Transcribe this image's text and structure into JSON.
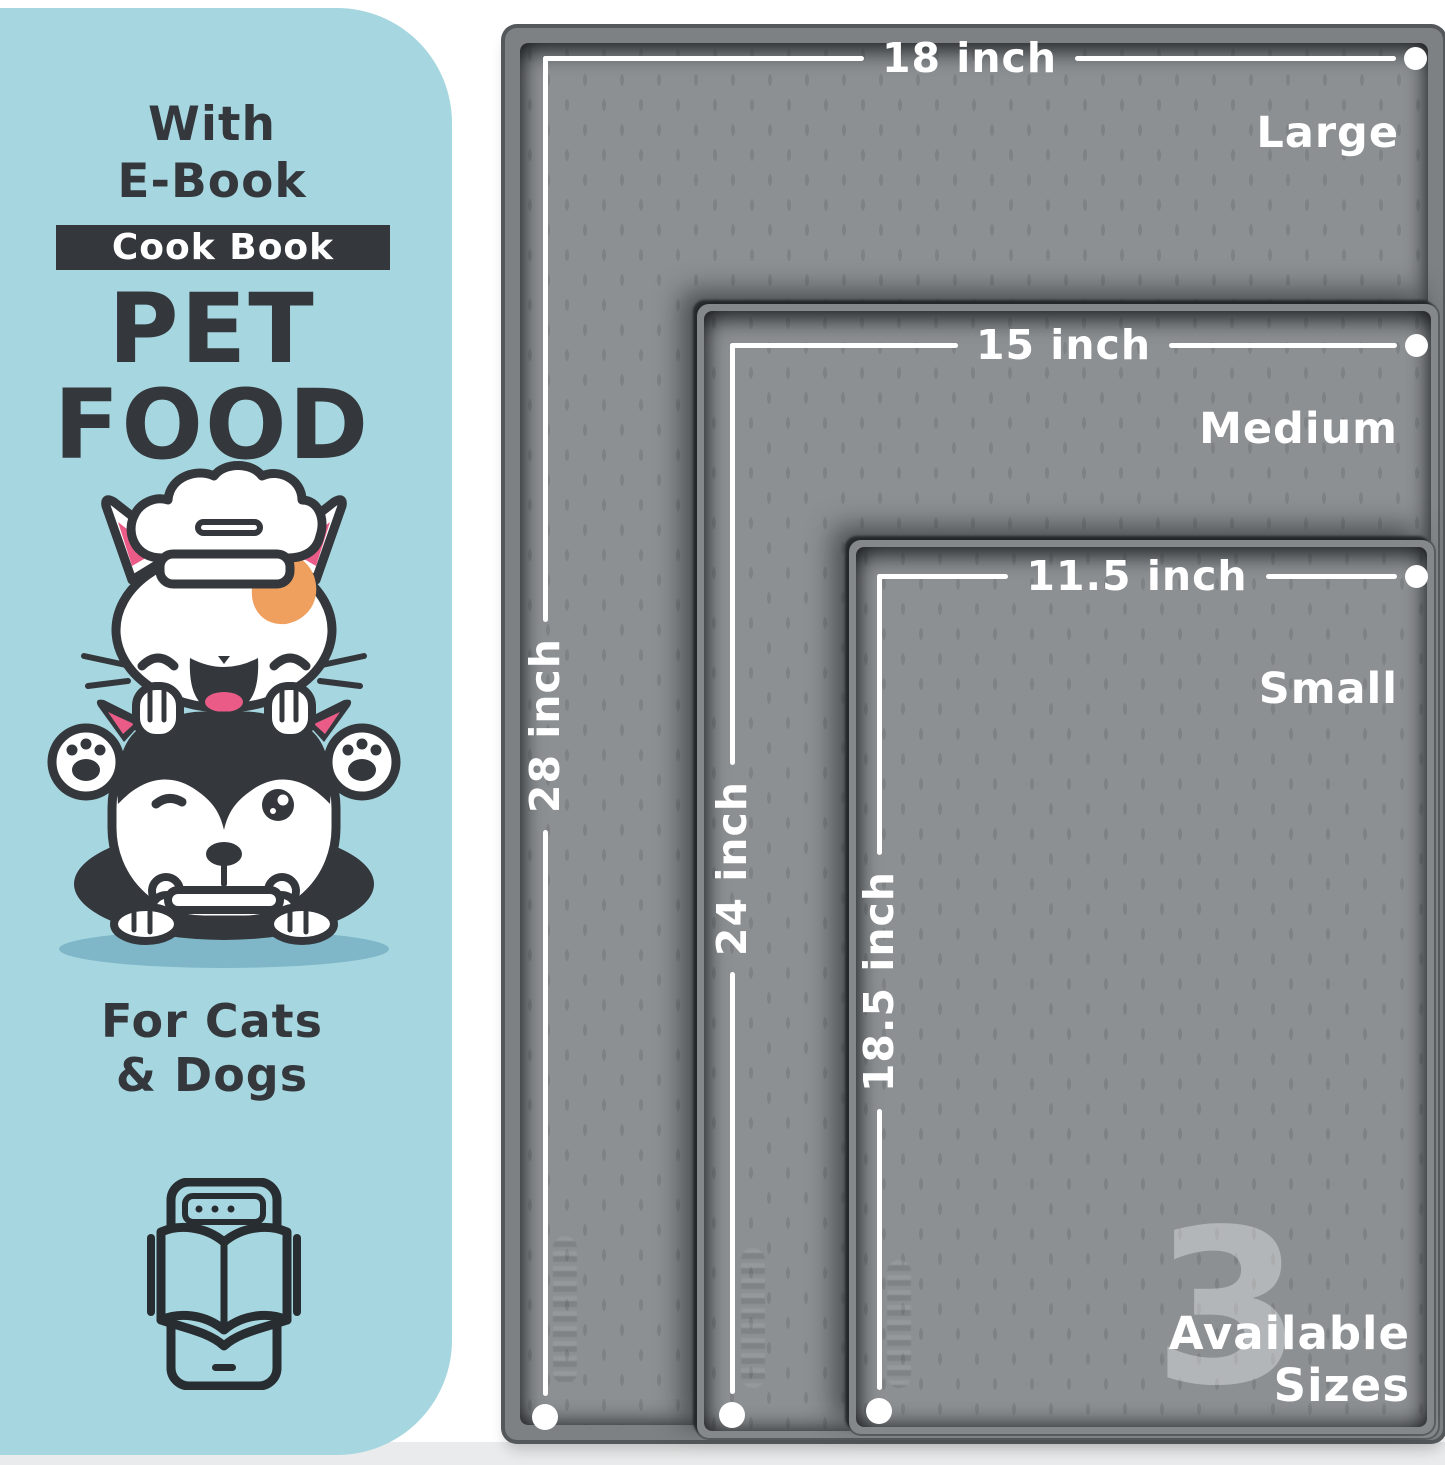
{
  "panel": {
    "intro_line1": "With",
    "intro_line2": "E-Book",
    "badge": "Cook Book",
    "title_line1": "PET",
    "title_line2": "FOOD",
    "audience_line1": "For Cats",
    "audience_line2": "& Dogs"
  },
  "mats": [
    {
      "name": "Large",
      "width": "18 inch",
      "height": "28 inch"
    },
    {
      "name": "Medium",
      "width": "15 inch",
      "height": "24 inch"
    },
    {
      "name": "Small",
      "width": "11.5 inch",
      "height": "18.5 inch"
    }
  ],
  "availability": {
    "count": "3",
    "word1": "Available",
    "word2": "Sizes"
  },
  "icons": {
    "pets_illustration": "cat-and-dog-chef-illustration",
    "ebook": "ebook-tablet-icon"
  },
  "colors": {
    "panel_bg": "#a6d7e0",
    "ink": "#34383d",
    "badge_bg": "#34383d",
    "badge_text": "#ffffff",
    "mat_surface": "#8c9093",
    "mat_frame": "#7d8184",
    "mat_edge": "#54585b",
    "measure_white": "#ffffff",
    "patch_orange": "#efa05f",
    "accent_pink": "#ea5c87",
    "shadow_teal": "#7fb7c8",
    "floor": "#e9ebec"
  }
}
